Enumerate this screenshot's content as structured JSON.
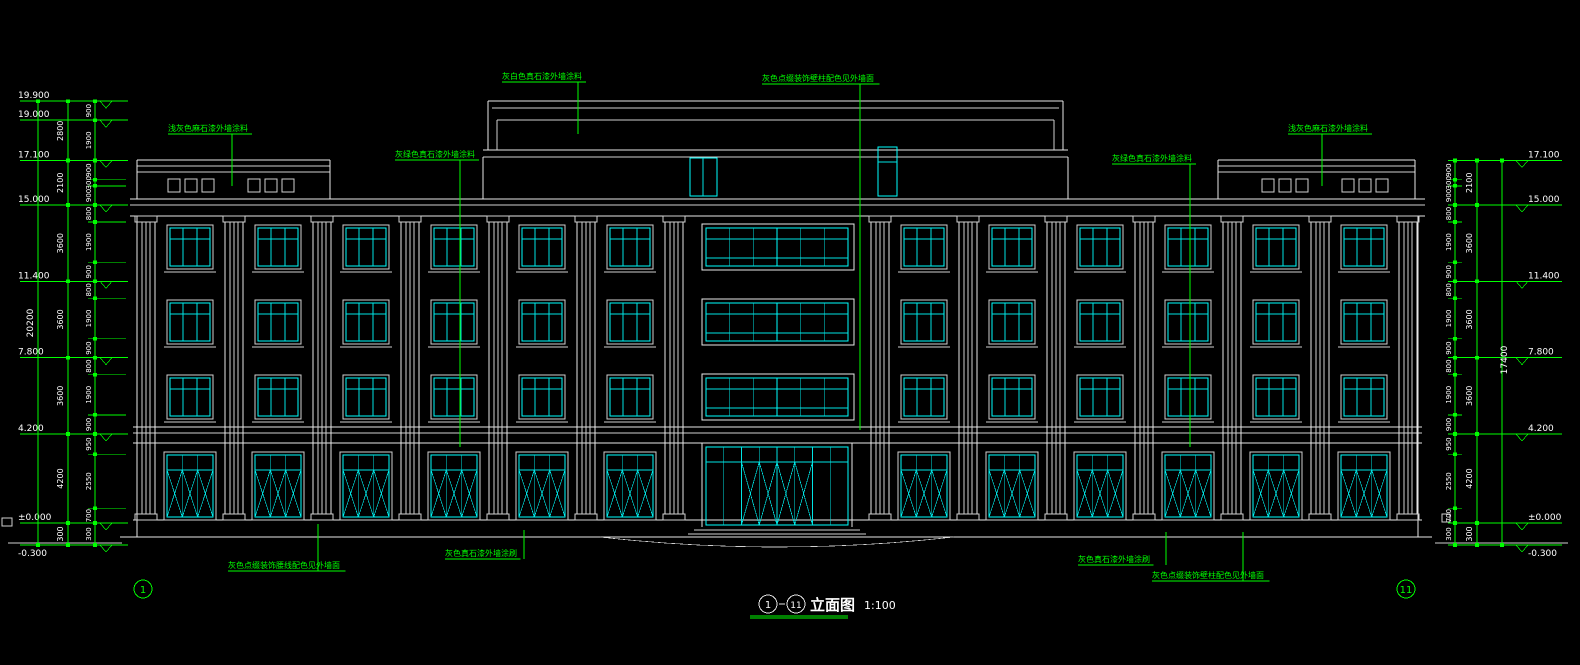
{
  "drawing": {
    "title": {
      "left_bubble": "1",
      "right_bubble": "11",
      "name": "立面图",
      "scale": "1:100"
    },
    "axis_bubbles": {
      "left": "1",
      "right": "11"
    },
    "levels_left": [
      {
        "value": 19.9,
        "label": "19.900"
      },
      {
        "value": 19.0,
        "label": "19.000"
      },
      {
        "value": 17.1,
        "label": "17.100"
      },
      {
        "value": 15.0,
        "label": "15.000"
      },
      {
        "value": 11.4,
        "label": "11.400"
      },
      {
        "value": 7.8,
        "label": "7.800"
      },
      {
        "value": 4.2,
        "label": "4.200"
      },
      {
        "value": 0.0,
        "label": "±0.000"
      },
      {
        "value": -0.3,
        "label": "-0.300"
      }
    ],
    "levels_right": [
      {
        "value": 17.1,
        "label": "17.100"
      },
      {
        "value": 15.0,
        "label": "15.000"
      },
      {
        "value": 11.4,
        "label": "11.400"
      },
      {
        "value": 7.8,
        "label": "7.800"
      },
      {
        "value": 4.2,
        "label": "4.200"
      },
      {
        "value": 0.0,
        "label": "±0.000"
      },
      {
        "value": -0.3,
        "label": "-0.300"
      }
    ],
    "dims": {
      "overall_left": "20200",
      "overall_right": "17400",
      "floors_left": [
        "2800",
        "2100",
        "3600",
        "3600",
        "3600",
        "4200",
        "300"
      ],
      "floors_right": [
        "2100",
        "3600",
        "3600",
        "3600",
        "4200",
        "300"
      ],
      "subs_left": [
        "900",
        "1900",
        "900",
        "300",
        "900",
        "800",
        "1900",
        "900",
        "800",
        "1900",
        "900",
        "800",
        "1900",
        "900",
        "950",
        "2550",
        "700",
        "300"
      ],
      "subs_right": [
        "900",
        "300",
        "900",
        "800",
        "1900",
        "900",
        "800",
        "1900",
        "900",
        "800",
        "1900",
        "900",
        "950",
        "2550",
        "700",
        "300"
      ]
    },
    "annotations": [
      {
        "id": "ann-top-left",
        "text": "浅灰色麻石漆外墙涂料"
      },
      {
        "id": "ann-mid-left",
        "text": "灰绿色真石漆外墙涂料"
      },
      {
        "id": "ann-top-center",
        "text": "灰白色真石漆外墙涂料"
      },
      {
        "id": "ann-top-center-right",
        "text": "灰色点缀装饰壁柱配色见外墙面"
      },
      {
        "id": "ann-mid-right",
        "text": "灰绿色真石漆外墙涂料"
      },
      {
        "id": "ann-top-right",
        "text": "浅灰色麻石漆外墙涂料"
      },
      {
        "id": "ann-bottom-left",
        "text": "灰色点缀装饰腰线配色见外墙面"
      },
      {
        "id": "ann-bottom-center",
        "text": "灰色真石漆外墙涂刷"
      },
      {
        "id": "ann-bottom-right-short",
        "text": "灰色真石漆外墙涂刷"
      },
      {
        "id": "ann-bottom-right-long",
        "text": "灰色点缀装饰壁柱配色见外墙面"
      }
    ],
    "colors": {
      "background": "#000000",
      "building_lines": "#e8e8e8",
      "glazing": "#00ffff",
      "dimensions_and_notes": "#00ff00"
    }
  }
}
